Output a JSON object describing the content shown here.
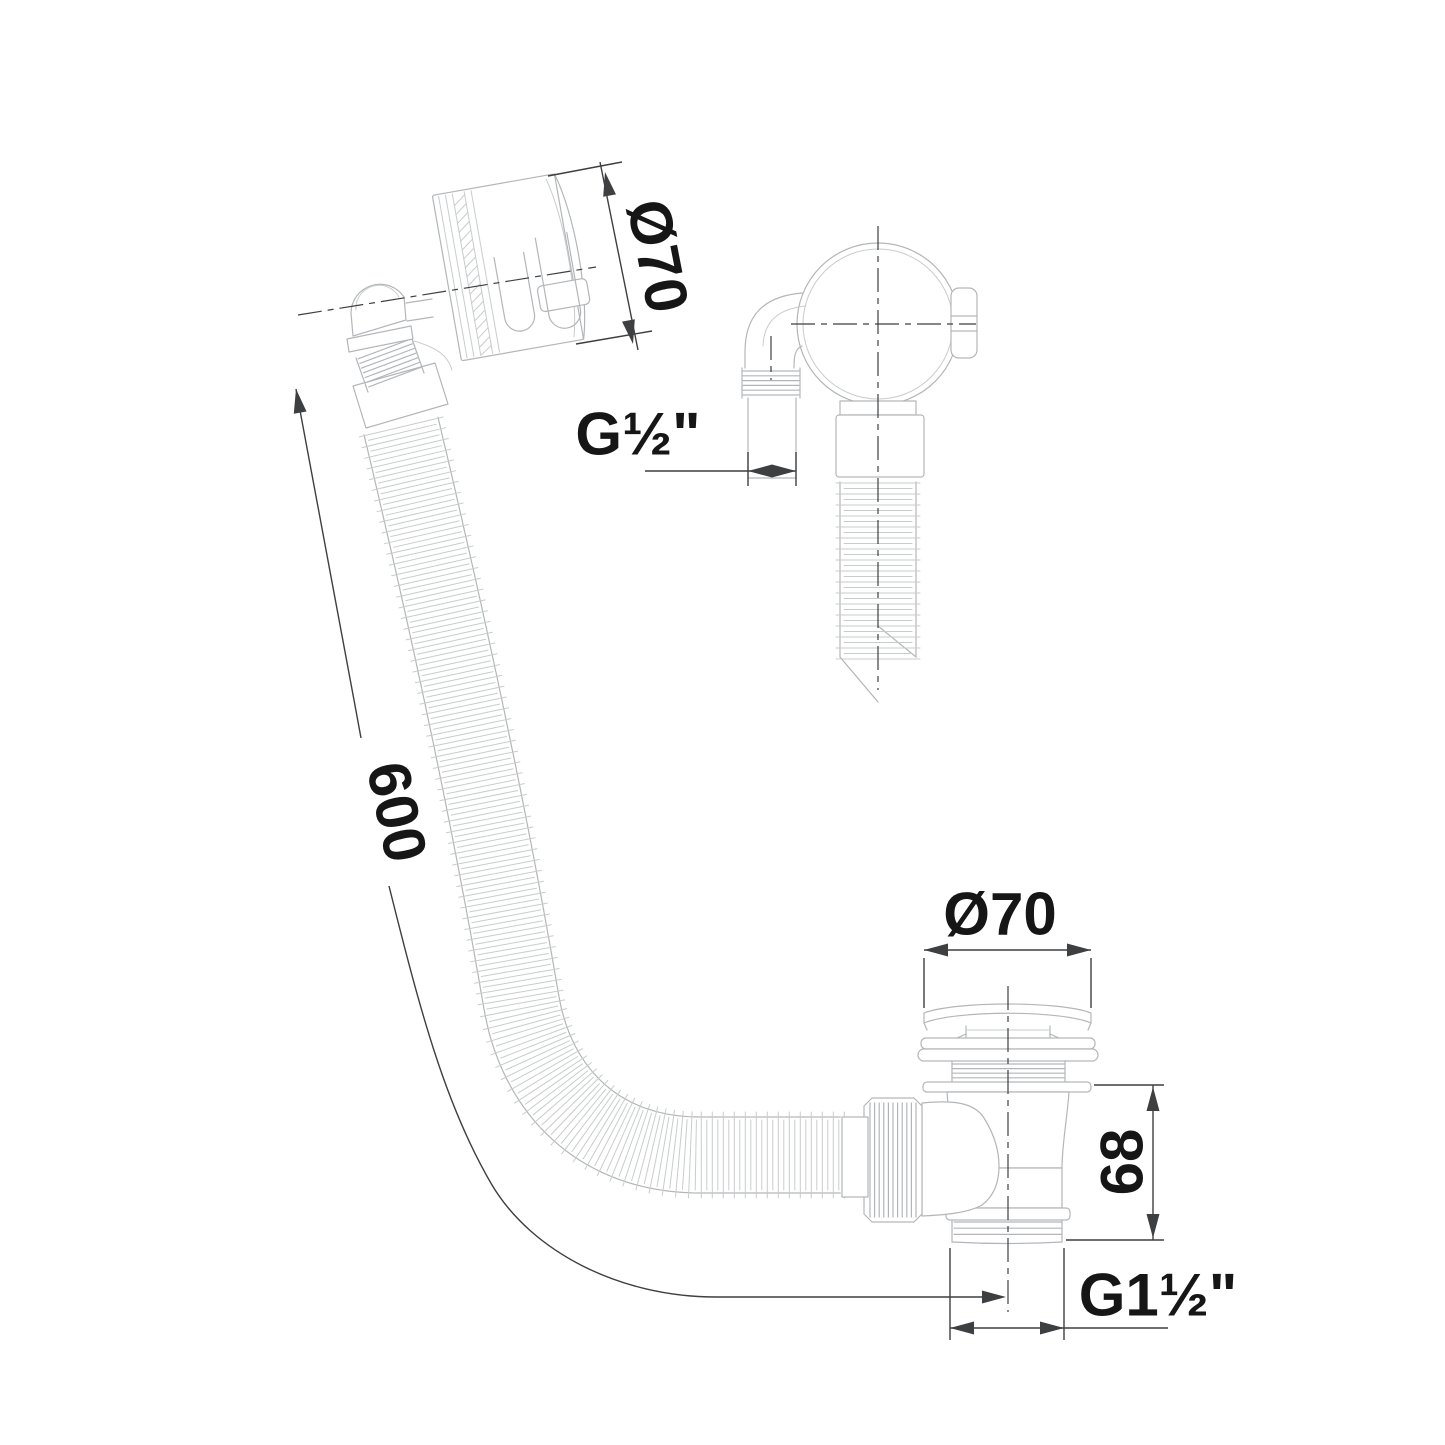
{
  "colors": {
    "bg": "#ffffff",
    "part": "#b3b6b9",
    "lite": "#c9cccd",
    "dim": "#3d3f41",
    "ink": "#161616"
  },
  "labels": {
    "overflow_diameter": "Ø70",
    "overflow_thread_size": "G½\"",
    "hose_length": "600",
    "waste_diameter": "Ø70",
    "waste_height": "68",
    "waste_thread_size": "G1½\""
  }
}
